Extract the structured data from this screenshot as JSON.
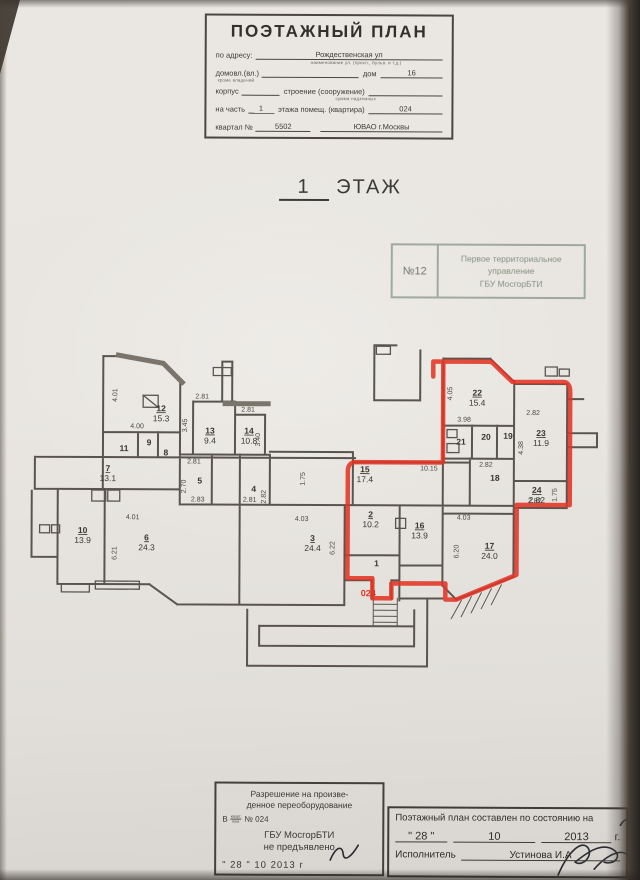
{
  "header": {
    "title": "ПОЭТАЖНЫЙ ПЛАН",
    "address_label": "по адресу:",
    "address_value": "Рождественская ул",
    "address_caption": "наименование ул. (просп., бульв. и т.д.)",
    "ownership_label": "домовл.(вл.)",
    "ownership_caption": "кроме владений",
    "house_label": "дом",
    "house_value": "16",
    "korpus_label": "корпус",
    "stroenie_label": "строение (сооружение)",
    "stroenie_caption": "сумма надземных",
    "part_label": "на часть",
    "part_value": "1",
    "part_label2": "этажа помещ. (квартира)",
    "apartment_value": "024",
    "kvartal_label": "квартал №",
    "kvartal_value": "5502",
    "okrug_value": "ЮВАО г.Москвы"
  },
  "floor_title": {
    "number": "1",
    "word": "ЭТАЖ"
  },
  "stamp": {
    "number": "№12",
    "line1": "Первое территориальное",
    "line2": "управление",
    "line3": "ГБУ МосгорБТИ"
  },
  "plan": {
    "apartment_label": "024",
    "red_color": "#e23425",
    "wall_color": "#59554e",
    "rooms": [
      {
        "num": "12",
        "area": "15.3",
        "x": 161,
        "y": 412
      },
      {
        "num": "13",
        "area": "9.4",
        "x": 210,
        "y": 434
      },
      {
        "num": "14",
        "area": "10.8",
        "x": 249,
        "y": 434
      },
      {
        "num": "7",
        "area": "13.1",
        "x": 108,
        "y": 472
      },
      {
        "num": "5",
        "x": 200,
        "y": 484
      },
      {
        "num": "4",
        "x": 254,
        "y": 492
      },
      {
        "num": "11",
        "x": 124,
        "y": 452
      },
      {
        "num": "9",
        "x": 149,
        "y": 446
      },
      {
        "num": "8",
        "x": 166,
        "y": 456
      },
      {
        "num": "10",
        "area": "13.9",
        "x": 83,
        "y": 534
      },
      {
        "num": "6",
        "area": "24.3",
        "x": 147,
        "y": 541
      },
      {
        "num": "3",
        "area": "24.4",
        "x": 313,
        "y": 541
      },
      {
        "num": "2",
        "area": "10.2",
        "x": 371,
        "y": 517
      },
      {
        "num": "1",
        "x": 377,
        "y": 566
      },
      {
        "num": "16",
        "area": "13.9",
        "x": 420,
        "y": 528
      },
      {
        "num": "17",
        "area": "24.0",
        "x": 490,
        "y": 548
      },
      {
        "num": "15",
        "area": "17.4",
        "x": 365,
        "y": 472
      },
      {
        "num": "18",
        "x": 495,
        "y": 480
      },
      {
        "num": "19",
        "x": 508,
        "y": 438
      },
      {
        "num": "20",
        "x": 486,
        "y": 439
      },
      {
        "num": "21",
        "x": 461,
        "y": 444
      },
      {
        "num": "22",
        "area": "15.4",
        "x": 477,
        "y": 395
      },
      {
        "num": "23",
        "area": "11.9",
        "x": 541,
        "y": 435
      },
      {
        "num": "24",
        "area": "2.82",
        "x": 537,
        "y": 492
      }
    ],
    "dims": [
      {
        "v": "4.01",
        "x": 117,
        "y": 396,
        "rot": true
      },
      {
        "v": "4.00",
        "x": 137,
        "y": 429
      },
      {
        "v": "3.45",
        "x": 187,
        "y": 426,
        "rot": true
      },
      {
        "v": "2.81",
        "x": 202,
        "y": 399
      },
      {
        "v": "2.81",
        "x": 248,
        "y": 412
      },
      {
        "v": "3.40",
        "x": 260,
        "y": 440,
        "rot": true
      },
      {
        "v": "2.81",
        "x": 194,
        "y": 464
      },
      {
        "v": "2.70",
        "x": 186,
        "y": 487,
        "rot": true
      },
      {
        "v": "2.83",
        "x": 198,
        "y": 502
      },
      {
        "v": "4.01",
        "x": 133,
        "y": 520
      },
      {
        "v": "6.21",
        "x": 117,
        "y": 554,
        "rot": true
      },
      {
        "v": "4.03",
        "x": 302,
        "y": 521
      },
      {
        "v": "6.22",
        "x": 335,
        "y": 548,
        "rot": true
      },
      {
        "v": "1.75",
        "x": 305,
        "y": 479,
        "rot": true
      },
      {
        "v": "2.82",
        "x": 266,
        "y": 497,
        "rot": true
      },
      {
        "v": "2.81",
        "x": 250,
        "y": 502
      },
      {
        "v": "10.15",
        "x": 429,
        "y": 470
      },
      {
        "v": "4.05",
        "x": 452,
        "y": 393,
        "rot": true
      },
      {
        "v": "3.98",
        "x": 464,
        "y": 421
      },
      {
        "v": "2.82",
        "x": 486,
        "y": 466
      },
      {
        "v": "2.82",
        "x": 533,
        "y": 414
      },
      {
        "v": "4.38",
        "x": 523,
        "y": 447,
        "rot": true
      },
      {
        "v": "1.75",
        "x": 557,
        "y": 494,
        "rot": true
      },
      {
        "v": "4.03",
        "x": 464,
        "y": 519
      },
      {
        "v": "6.20",
        "x": 459,
        "y": 551,
        "rot": true
      },
      {
        "v": "2.82",
        "x": 535,
        "y": 502
      }
    ]
  },
  "footer_left": {
    "line1": "Разрешение на произве-",
    "line2": "денное переоборудование",
    "in_label": "В",
    "in_small1": "кварт.",
    "in_small2": "пом.",
    "in_number": "№ 024",
    "org": "ГБУ МосгорБТИ",
    "status": "не предъявлено",
    "date": "\" 28 \"  10   2013 г"
  },
  "footer_right": {
    "line1": "Поэтажный план составлен по состоянию на",
    "day_quoted": "\" 28 \"",
    "month": "10",
    "year": "2013",
    "year_suffix": "г.",
    "executor_label": "Исполнитель",
    "executor_value": "Устинова И.А"
  }
}
